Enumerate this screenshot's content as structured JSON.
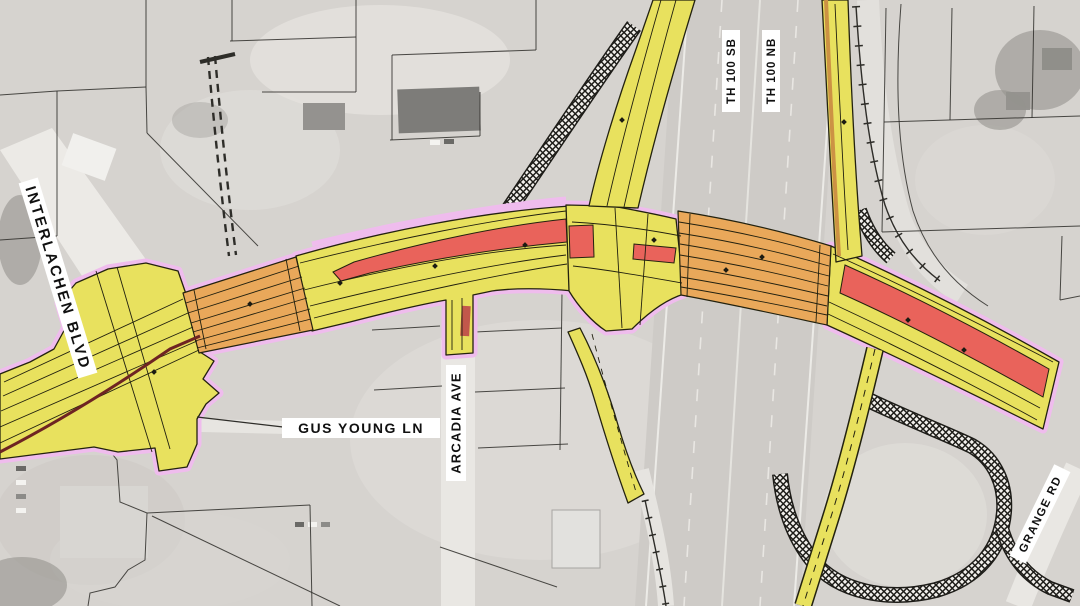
{
  "colors": {
    "aerial_base": "#d6d3cf",
    "aerial_road_white": "#eceae6",
    "highway_gray": "#cecbc7",
    "highway_marking_white": "#f0eeea",
    "parcel_line": "#2e2d29",
    "pavement_yellow": "#e8e15e",
    "bridge_orange": "#e9a85a",
    "median_red": "#e9635b",
    "curb_pink": "#efbced",
    "ramp_edge_tan": "#cc9244",
    "rail_maroon": "#6e2422",
    "hatch_background": "#f2f0ec",
    "hatch_line": "#1d1c18",
    "lane_line": "#21200f",
    "driveway_red_brown": "#c2574b",
    "label_background": "#ffffff",
    "label_text": "#101010"
  },
  "labels": {
    "interlachen": {
      "text": "INTERLACHEN BLVD"
    },
    "gus_young": {
      "text": "GUS YOUNG LN"
    },
    "arcadia": {
      "text": "ARCADIA AVE"
    },
    "th100_sb": {
      "text": "TH 100 SB"
    },
    "th100_nb": {
      "text": "TH 100 NB"
    },
    "grange": {
      "text": "GRANGE RD"
    }
  }
}
